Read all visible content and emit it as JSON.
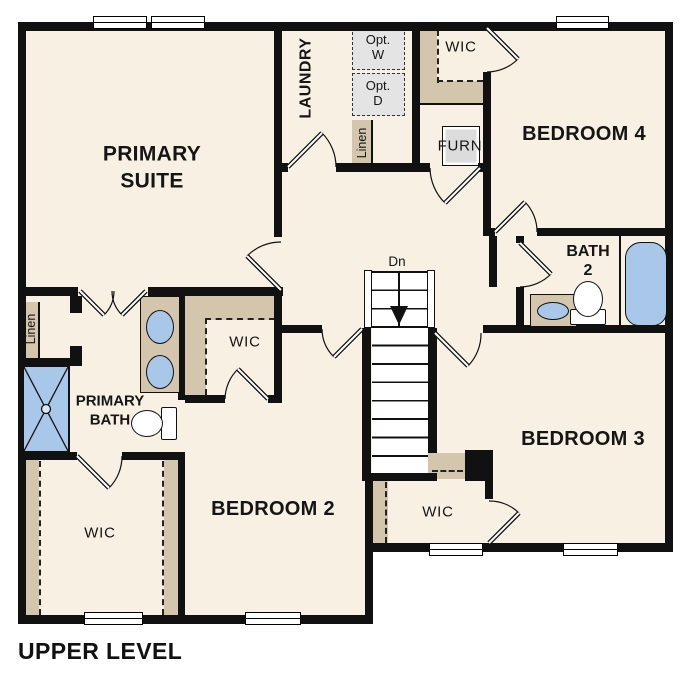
{
  "colors": {
    "floor": "#f7f0e3",
    "wall": "#111111",
    "shelf_tan": "#d3c6ad",
    "fixture_blue": "#a9c7e9",
    "appliance_gray": "#e4e4e4"
  },
  "plan": {
    "title": "UPPER LEVEL",
    "labels": {
      "primary_suite": "PRIMARY\nSUITE",
      "laundry": "LAUNDRY",
      "opt_w": "Opt.\nW",
      "opt_d": "Opt.\nD",
      "wic_top": "WIC",
      "bedroom4": "BEDROOM 4",
      "furn": "FURN",
      "linen_top": "Linen",
      "bath2": "BATH\n2",
      "dn": "Dn",
      "linen_left": "Linen",
      "primary_bath": "PRIMARY\nBATH",
      "wic_mid": "WIC",
      "wic_left": "WIC",
      "bedroom2": "BEDROOM 2",
      "bedroom3": "BEDROOM 3",
      "wic_center": "WIC"
    }
  }
}
